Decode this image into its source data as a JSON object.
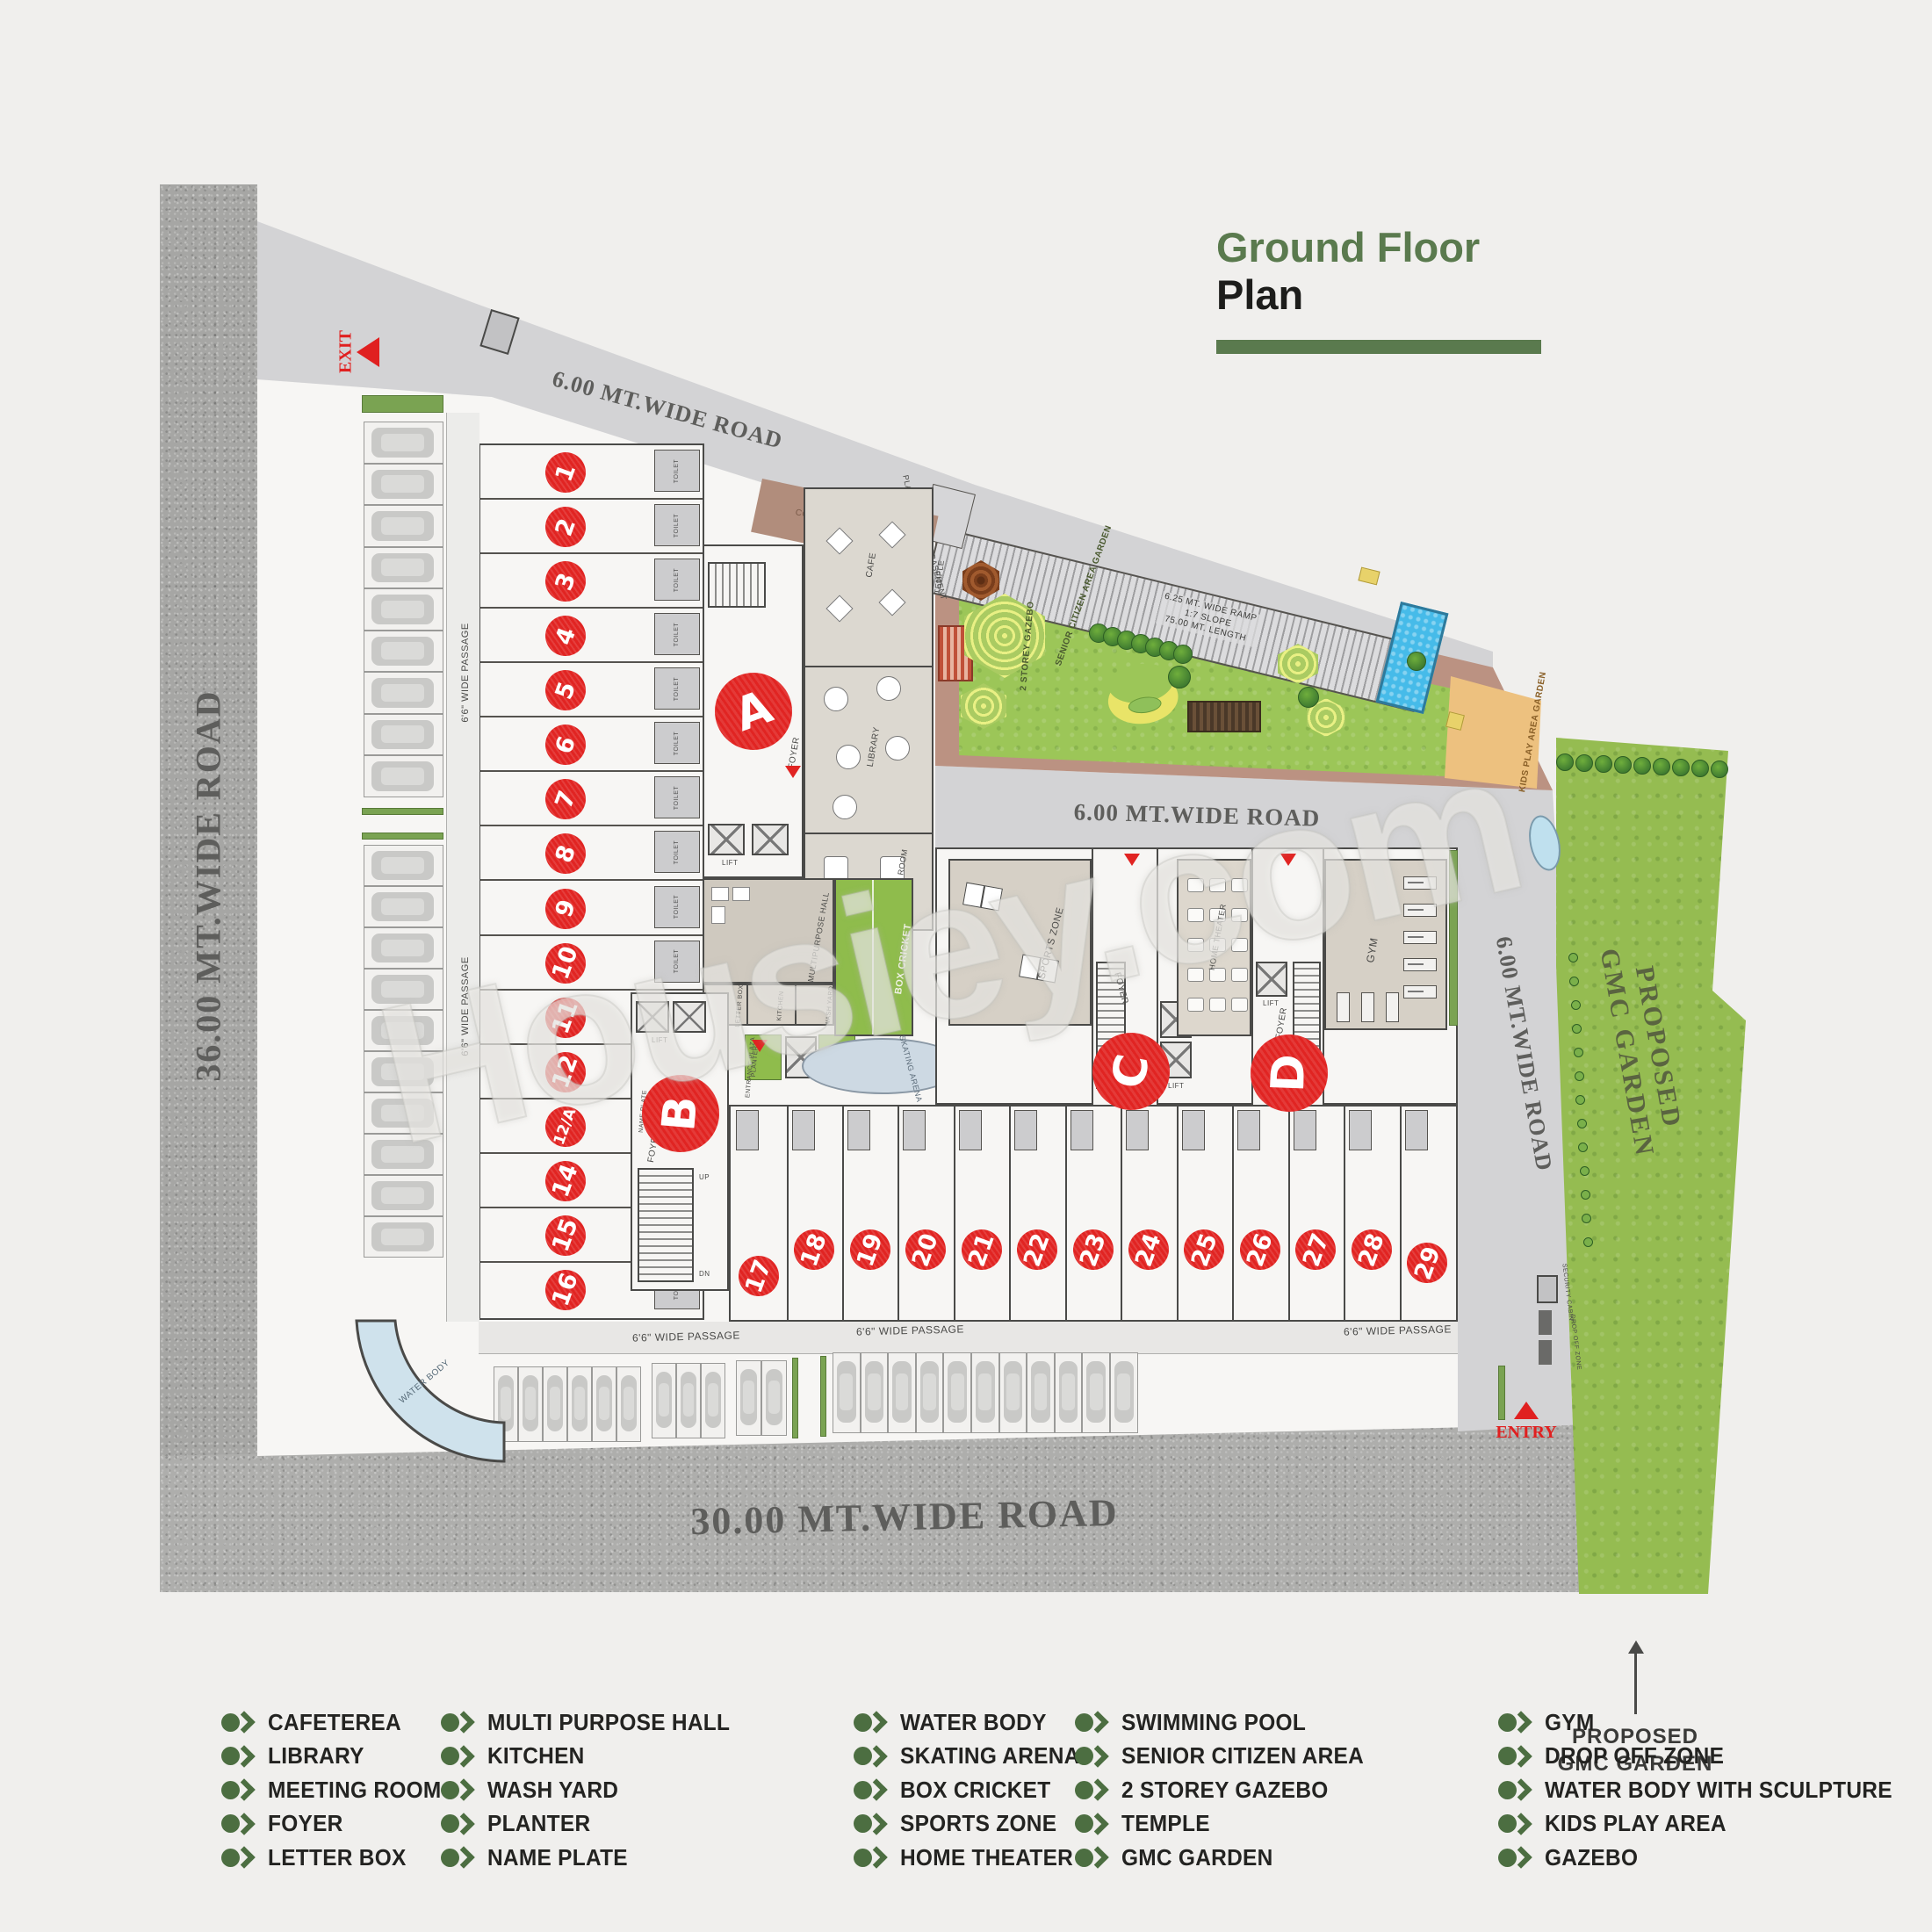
{
  "title": {
    "line1": "Ground Floor",
    "line2": "Plan"
  },
  "watermark": "Housiey.com",
  "roads": {
    "left": "36.00 MT.WIDE ROAD",
    "bottom": "30.00 MT.WIDE ROAD",
    "top": "6.00 MT.WIDE ROAD",
    "middle": "6.00 MT.WIDE ROAD",
    "right": "6.00 MT.WIDE ROAD"
  },
  "markers": {
    "exit": "EXIT",
    "entry": "ENTRY"
  },
  "blocks": [
    "A",
    "B",
    "C",
    "D"
  ],
  "units": {
    "left": [
      "1",
      "2",
      "3",
      "4",
      "5",
      "6",
      "7",
      "8",
      "9",
      "10",
      "11",
      "12",
      "12/A",
      "14",
      "15",
      "16"
    ],
    "bottom": [
      "17",
      "18",
      "19",
      "20",
      "21",
      "22",
      "23",
      "24",
      "25",
      "26",
      "27",
      "28",
      "29"
    ]
  },
  "plan_labels": {
    "courtyard": "COURTYARD",
    "cafe": "CAFE",
    "library": "LIBRARY",
    "meeting_room": "MEETING ROOM",
    "foyer": "FOYER",
    "toilet": "TOILET",
    "lift": "LIFT",
    "stair_up": "UP",
    "stair_dn": "DN",
    "multipurpose_hall": "MULTIPURPOSE HALL",
    "kitchen": "KITCHEN",
    "wash_yard": "WASH YARD",
    "letter_box": "LETTER BOX",
    "name_plate": "NAME PLATE",
    "entrance_plaza": "ENTRANCE PLAZA",
    "planter": "PLANTER",
    "box_cricket": "BOX CRICKET",
    "skating_arena": "SKATING ARENA",
    "sports_zone": "SPORTS ZONE",
    "home_theater": "HOME THEATER",
    "gym": "GYM",
    "temple": "TEMPLE",
    "two_storey_gazebo": "2 STOREY GAZEBO",
    "senior_citizen_area": "SENIOR CITIZEN AREA GARDEN",
    "kids_play_area": "KIDS PLAY AREA GARDEN",
    "water_body": "WATER BODY",
    "security_cabin": "SECURITY CABIN",
    "drop_off": "DROP OFF ZONE",
    "passage": "6'6\" WIDE PASSAGE",
    "ramp_line1": "6.25 MT. WIDE RAMP",
    "ramp_line2": "1:7 SLOPE",
    "ramp_line3": "75.00 MT. LENGTH",
    "dn_basement": "DN TO 1ST BASEMENT",
    "platform": "PLAT FORM 6.25X5.24",
    "gmc_garden_line1": "PROPOSED",
    "gmc_garden_line2": "GMC GARDEN"
  },
  "annotation": {
    "line1": "PROPOSED",
    "line2": "GMC GARDEN"
  },
  "legend": {
    "columns": [
      [
        "CAFETEREA",
        "LIBRARY",
        "MEETING ROOM",
        "FOYER",
        "LETTER BOX"
      ],
      [
        "MULTI PURPOSE HALL",
        "KITCHEN",
        "WASH YARD",
        "PLANTER",
        "NAME PLATE"
      ],
      [
        "WATER BODY",
        "SKATING ARENA",
        "BOX CRICKET",
        "SPORTS ZONE",
        "HOME THEATER"
      ],
      [
        "SWIMMING POOL",
        "SENIOR CITIZEN AREA",
        "2 STOREY GAZEBO",
        "TEMPLE",
        "GMC GARDEN"
      ],
      [
        "GYM",
        "DROP OFF ZONE",
        "WATER BODY WITH SCULPTURE",
        "KIDS PLAY AREA",
        "GAZEBO"
      ]
    ]
  },
  "colors": {
    "accent_green": "#5a7a4e",
    "unit_red": "#e12422",
    "grass_green": "#9cc658",
    "gmc_green": "#95bc51",
    "pool_blue": "#46bbe9"
  }
}
